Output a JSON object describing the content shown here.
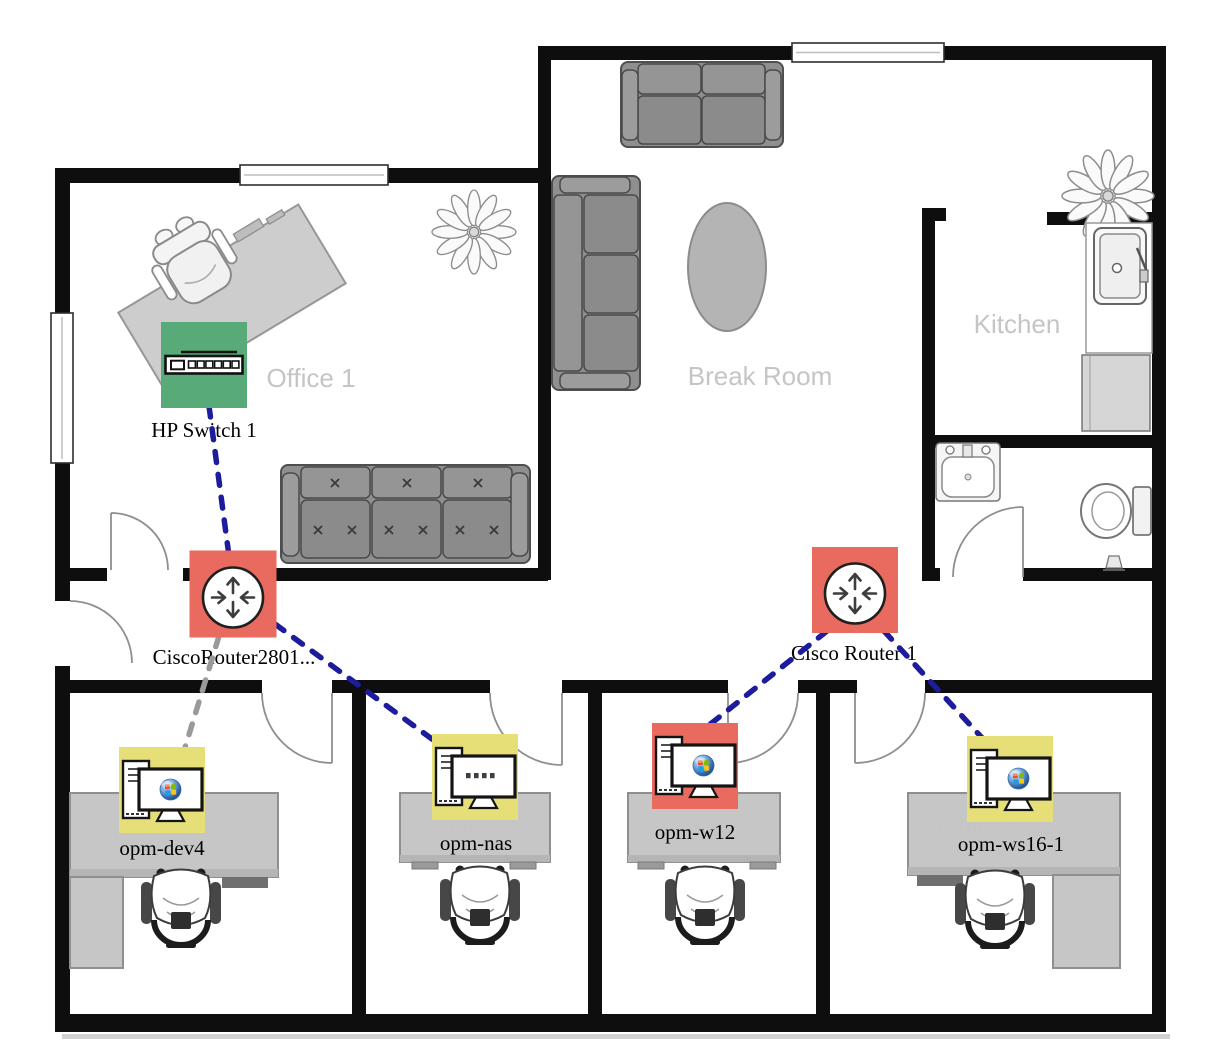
{
  "map": {
    "background": "#ffffff",
    "status_colors": {
      "up": "#58aa78",
      "down": "#e96a5e",
      "warning": "#e6df78"
    },
    "link_styles": {
      "active": {
        "color": "#1c1c9c"
      },
      "unknown": {
        "color": "#9a9a9a"
      }
    },
    "rooms": [
      {
        "id": "office-1",
        "label": "Office 1",
        "x": 311,
        "y": 387
      },
      {
        "id": "break-room",
        "label": "Break Room",
        "x": 760,
        "y": 385
      },
      {
        "id": "kitchen",
        "label": "Kitchen",
        "x": 1017,
        "y": 333
      },
      {
        "id": "office-2",
        "label": "Office 2",
        "x": 190,
        "y": 835
      },
      {
        "id": "office-3",
        "label": "Office 3",
        "x": 479,
        "y": 836
      },
      {
        "id": "office-4",
        "label": "Office 4",
        "x": 705,
        "y": 836
      },
      {
        "id": "office-5",
        "label": "Office 5",
        "x": 982,
        "y": 836
      }
    ],
    "nodes": [
      {
        "id": "hp-switch-1",
        "label": "HP Switch 1",
        "type": "switch",
        "status": "up",
        "x": 204,
        "y": 365,
        "size": 86,
        "label_x": 204,
        "label_y": 437
      },
      {
        "id": "cisco-router-2801",
        "label": "CiscoRouter2801...",
        "type": "router",
        "status": "down",
        "x": 233,
        "y": 594,
        "size": 87,
        "label_x": 234,
        "label_y": 664
      },
      {
        "id": "cisco-router-1",
        "label": "Cisco Router 1",
        "type": "router",
        "status": "down",
        "x": 855,
        "y": 590,
        "size": 86,
        "label_x": 854,
        "label_y": 660
      },
      {
        "id": "opm-dev4",
        "label": "opm-dev4",
        "type": "workstation",
        "status": "warning",
        "x": 162,
        "y": 790,
        "size": 86,
        "label_x": 162,
        "label_y": 855
      },
      {
        "id": "opm-nas",
        "label": "opm-nas",
        "type": "nas",
        "status": "warning",
        "x": 475,
        "y": 777,
        "size": 86,
        "label_x": 476,
        "label_y": 850
      },
      {
        "id": "opm-w12",
        "label": "opm-w12",
        "type": "workstation",
        "status": "down",
        "x": 695,
        "y": 766,
        "size": 86,
        "label_x": 695,
        "label_y": 839
      },
      {
        "id": "opm-ws16-1",
        "label": "opm-ws16-1",
        "type": "workstation",
        "status": "warning",
        "x": 1010,
        "y": 779,
        "size": 86,
        "label_x": 1011,
        "label_y": 851
      }
    ],
    "links": [
      {
        "from": "hp-switch-1",
        "to": "cisco-router-2801",
        "status": "active",
        "x1": 209,
        "y1": 406,
        "x2": 229,
        "y2": 556
      },
      {
        "from": "cisco-router-2801",
        "to": "opm-dev4",
        "status": "unknown",
        "x1": 219,
        "y1": 636,
        "x2": 184,
        "y2": 751
      },
      {
        "from": "cisco-router-2801",
        "to": "opm-nas",
        "status": "active",
        "x1": 275,
        "y1": 624,
        "x2": 436,
        "y2": 742
      },
      {
        "from": "cisco-router-1",
        "to": "opm-w12",
        "status": "active",
        "x1": 827,
        "y1": 631,
        "x2": 708,
        "y2": 726
      },
      {
        "from": "cisco-router-1",
        "to": "opm-ws16-1",
        "status": "active",
        "x1": 884,
        "y1": 631,
        "x2": 984,
        "y2": 740
      }
    ]
  }
}
